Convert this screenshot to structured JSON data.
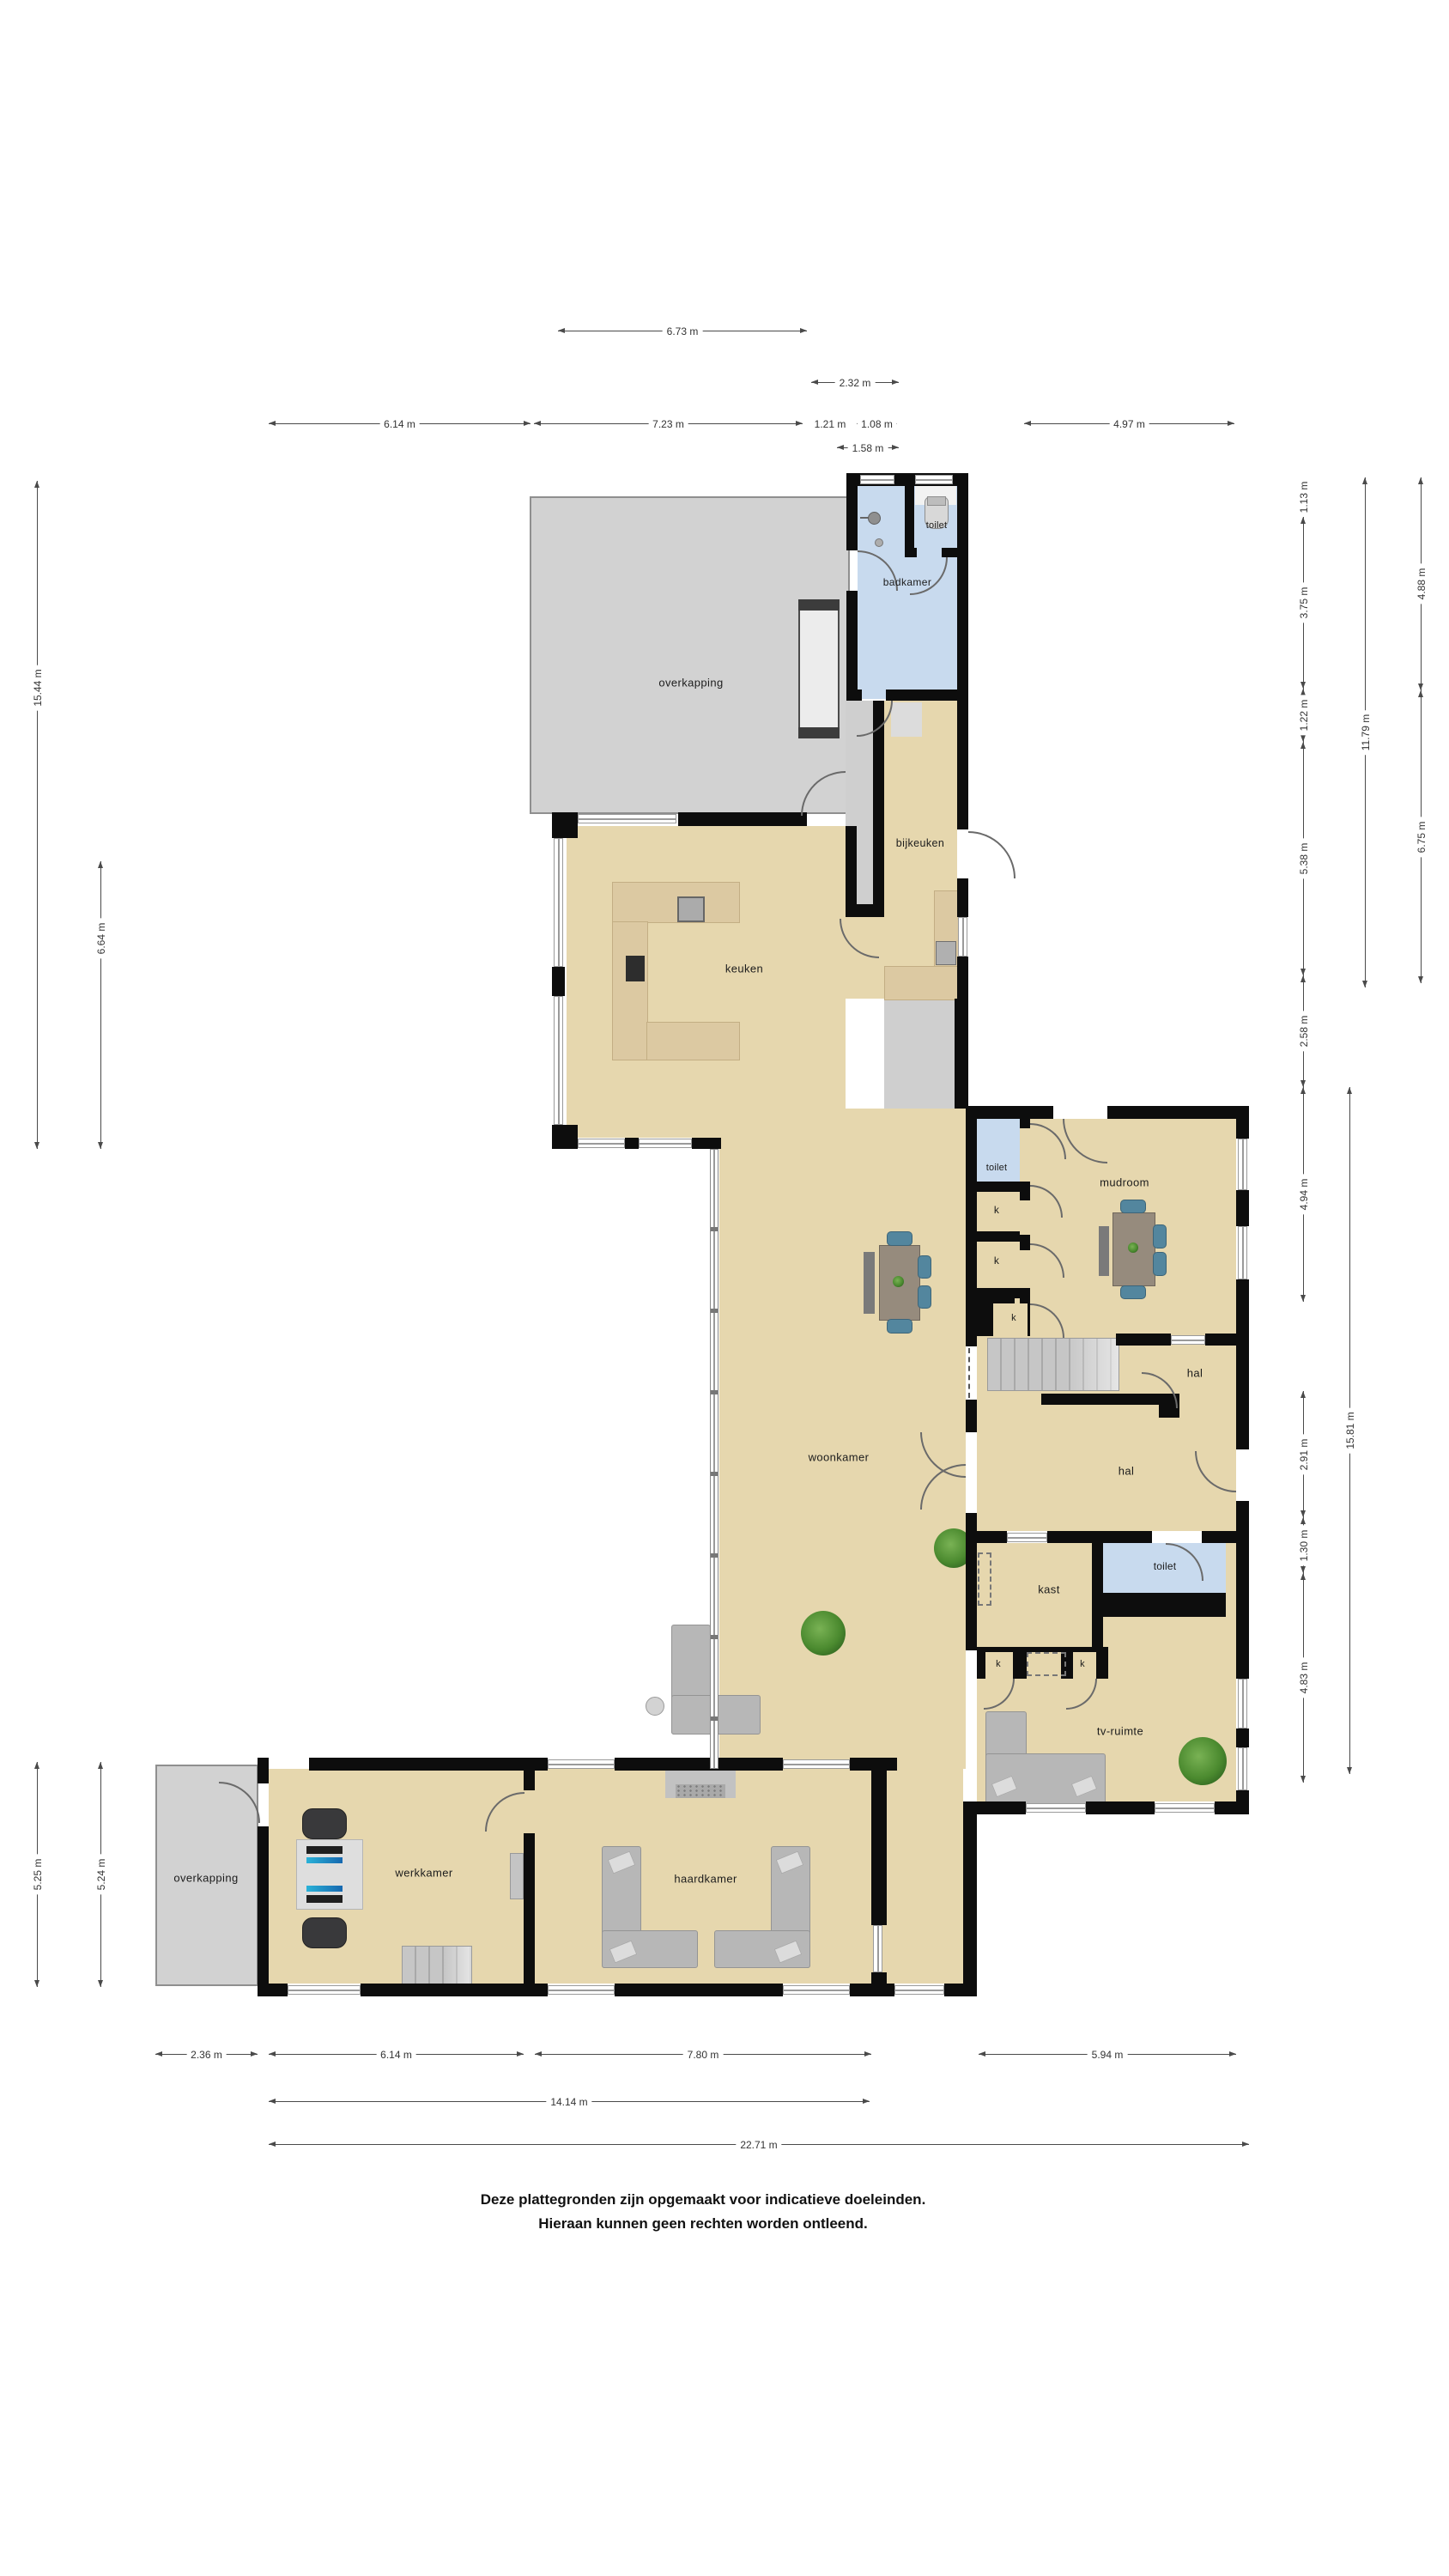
{
  "rooms": {
    "overkapping": "overkapping",
    "toilet": "toilet",
    "badkamer": "badkamer",
    "bijkeuken": "bijkeuken",
    "keuken": "keuken",
    "woonkamer": "woonkamer",
    "mudroom": "mudroom",
    "hal": "hal",
    "kast": "kast",
    "k": "k",
    "tv_ruimte": "tv-ruimte",
    "werkkamer": "werkkamer",
    "haardkamer": "haardkamer"
  },
  "dims": {
    "t673": "6.73 m",
    "t232": "2.32 m",
    "t614": "6.14 m",
    "t723": "7.23 m",
    "t121": "1.21 m",
    "t108": "1.08 m",
    "t497": "4.97 m",
    "t158": "1.58 m",
    "l1544": "15.44 m",
    "l664": "6.64 m",
    "l525": "5.25 m",
    "l524": "5.24 m",
    "r113": "1.13 m",
    "r375": "3.75 m",
    "r122": "1.22 m",
    "r538": "5.38 m",
    "r258": "2.58 m",
    "r494": "4.94 m",
    "r291": "2.91 m",
    "r130": "1.30 m",
    "r483": "4.83 m",
    "r1179": "11.79 m",
    "r1581": "15.81 m",
    "r488": "4.88 m",
    "r675": "6.75 m",
    "b236": "2.36 m",
    "b614": "6.14 m",
    "b780": "7.80 m",
    "b594": "5.94 m",
    "b1414": "14.14 m",
    "b2271": "22.71 m"
  },
  "disclaimer": {
    "line1": "Deze plattegronden zijn opgemaakt voor indicatieve doeleinden.",
    "line2": "Hieraan kunnen geen rechten worden ontleend."
  },
  "colors": {
    "room_fill": "#e6d7ae",
    "wet_room_fill": "#c8daee",
    "covered_area_fill": "#d2d2d2",
    "wall": "#0d0d0d",
    "counter": "#dcc9a2",
    "chair_accent": "#53869e"
  }
}
